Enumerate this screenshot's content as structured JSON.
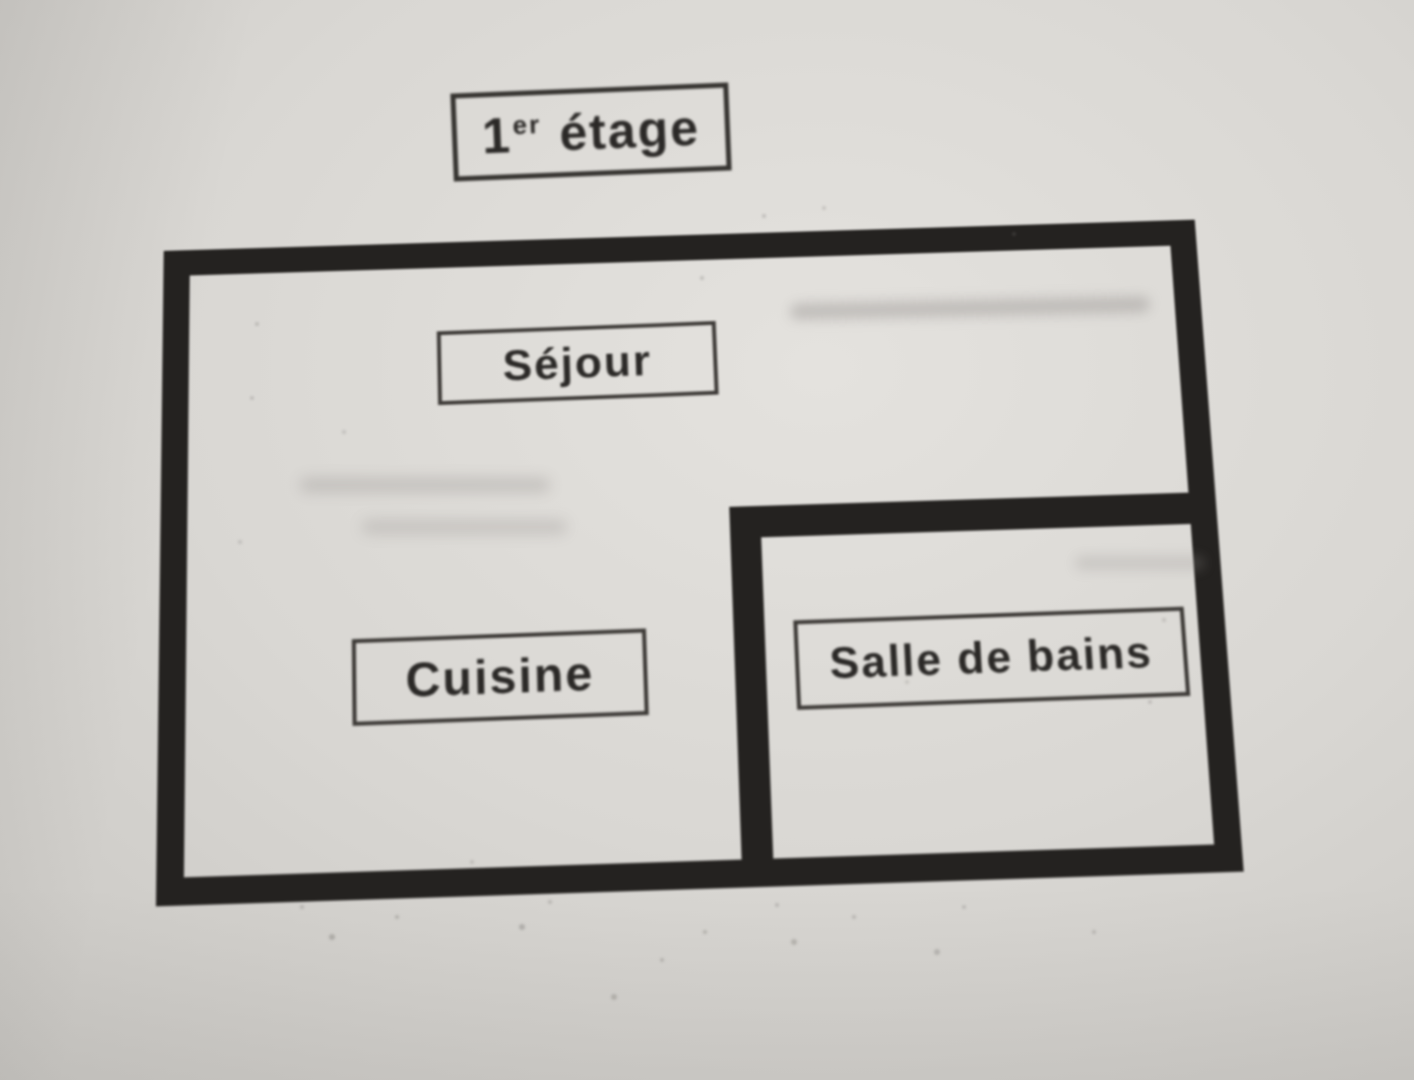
{
  "document": {
    "kind": "hand-drawn floor plan (photograph of paper)",
    "language": "French"
  },
  "title": {
    "number": "1",
    "superscript": "er",
    "rest": " étage"
  },
  "rooms": [
    {
      "id": "sejour",
      "label": "Séjour"
    },
    {
      "id": "cuisine",
      "label": "Cuisine"
    },
    {
      "id": "salle-de-bains",
      "label": "Salle de bains"
    }
  ],
  "colors": {
    "paper": "#d9d7d3",
    "wall": "#242220",
    "label_border": "#3c3936",
    "text": "#2b2927"
  }
}
